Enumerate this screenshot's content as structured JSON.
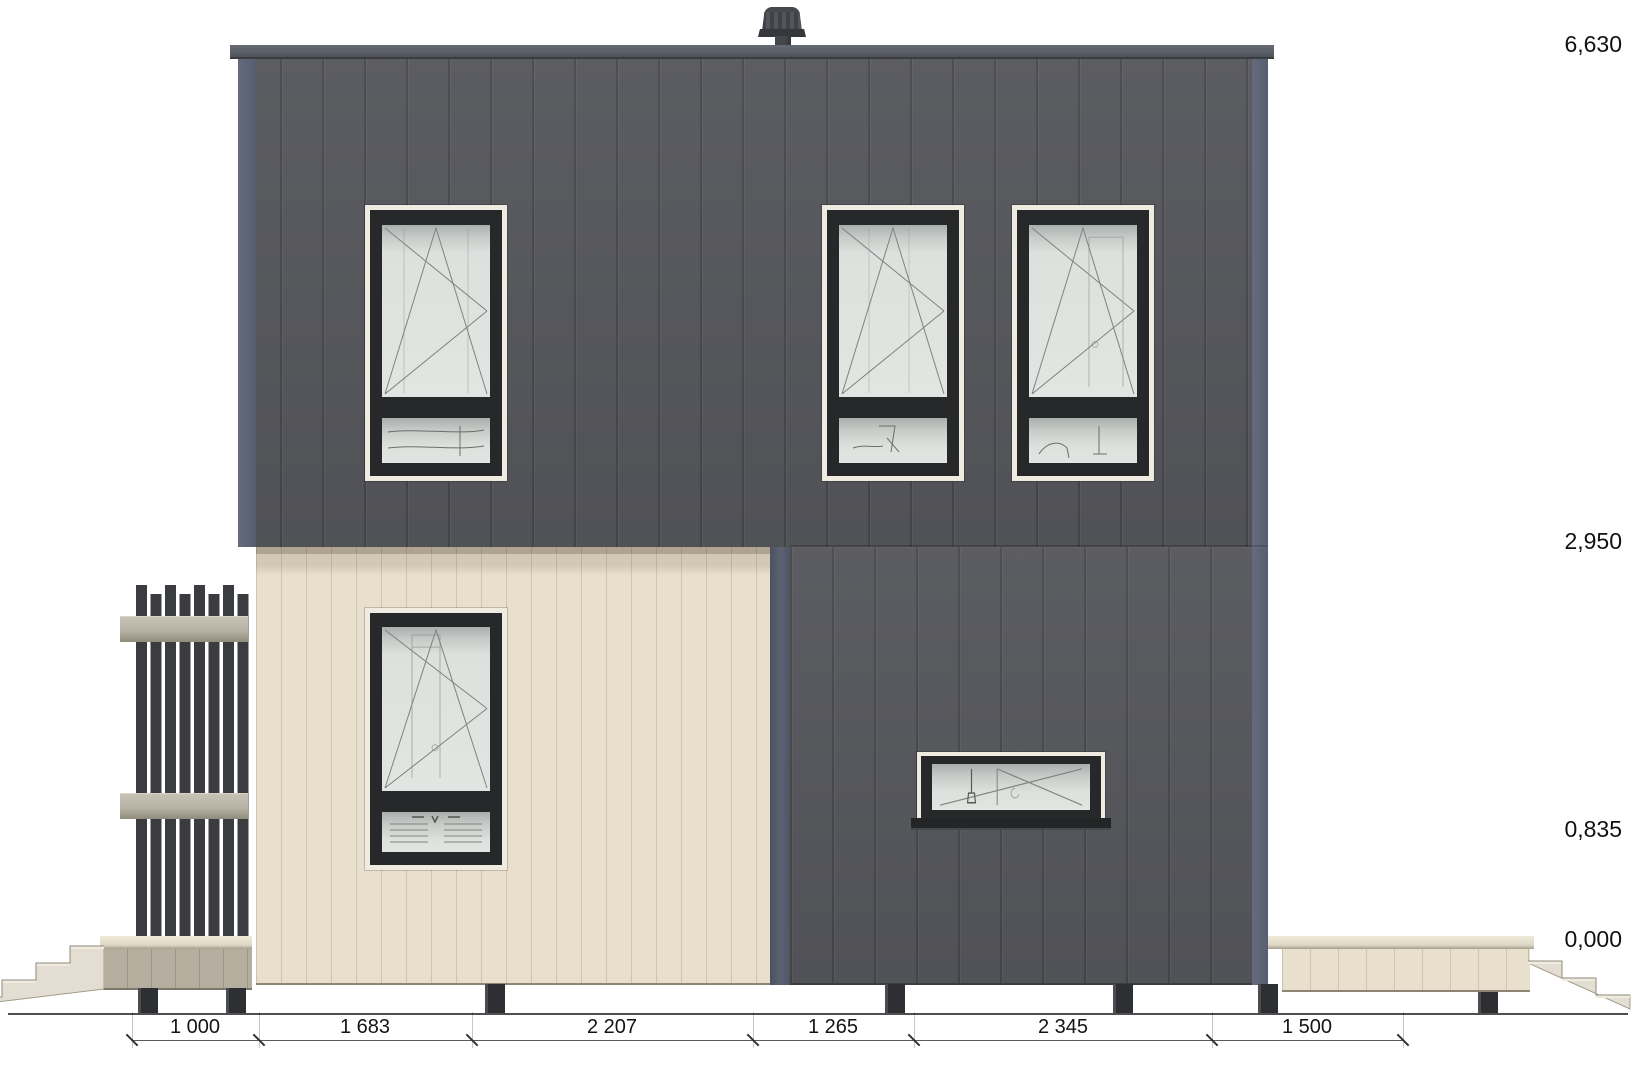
{
  "drawing": {
    "elevation_levels": [
      {
        "label": "6,630"
      },
      {
        "label": "2,950"
      },
      {
        "label": "0,835"
      },
      {
        "label": "0,000"
      }
    ],
    "dimensions_mm": [
      {
        "label": "1 000"
      },
      {
        "label": "1 683"
      },
      {
        "label": "2 207"
      },
      {
        "label": "1 265"
      },
      {
        "label": "2 345"
      },
      {
        "label": "1 500"
      }
    ],
    "colors": {
      "facade_dark": "#55565b",
      "facade_cream": "#e8dfcc",
      "corner_trim": "#5c6374",
      "window_frame": "#26282a",
      "window_trim": "#efebe0",
      "glass": "#dde1de",
      "fence_slat": "#3a3c40",
      "fence_rail": "#b6b3a4",
      "stairs": "#e3ded1",
      "foundation_post": "#2d2f32"
    }
  }
}
